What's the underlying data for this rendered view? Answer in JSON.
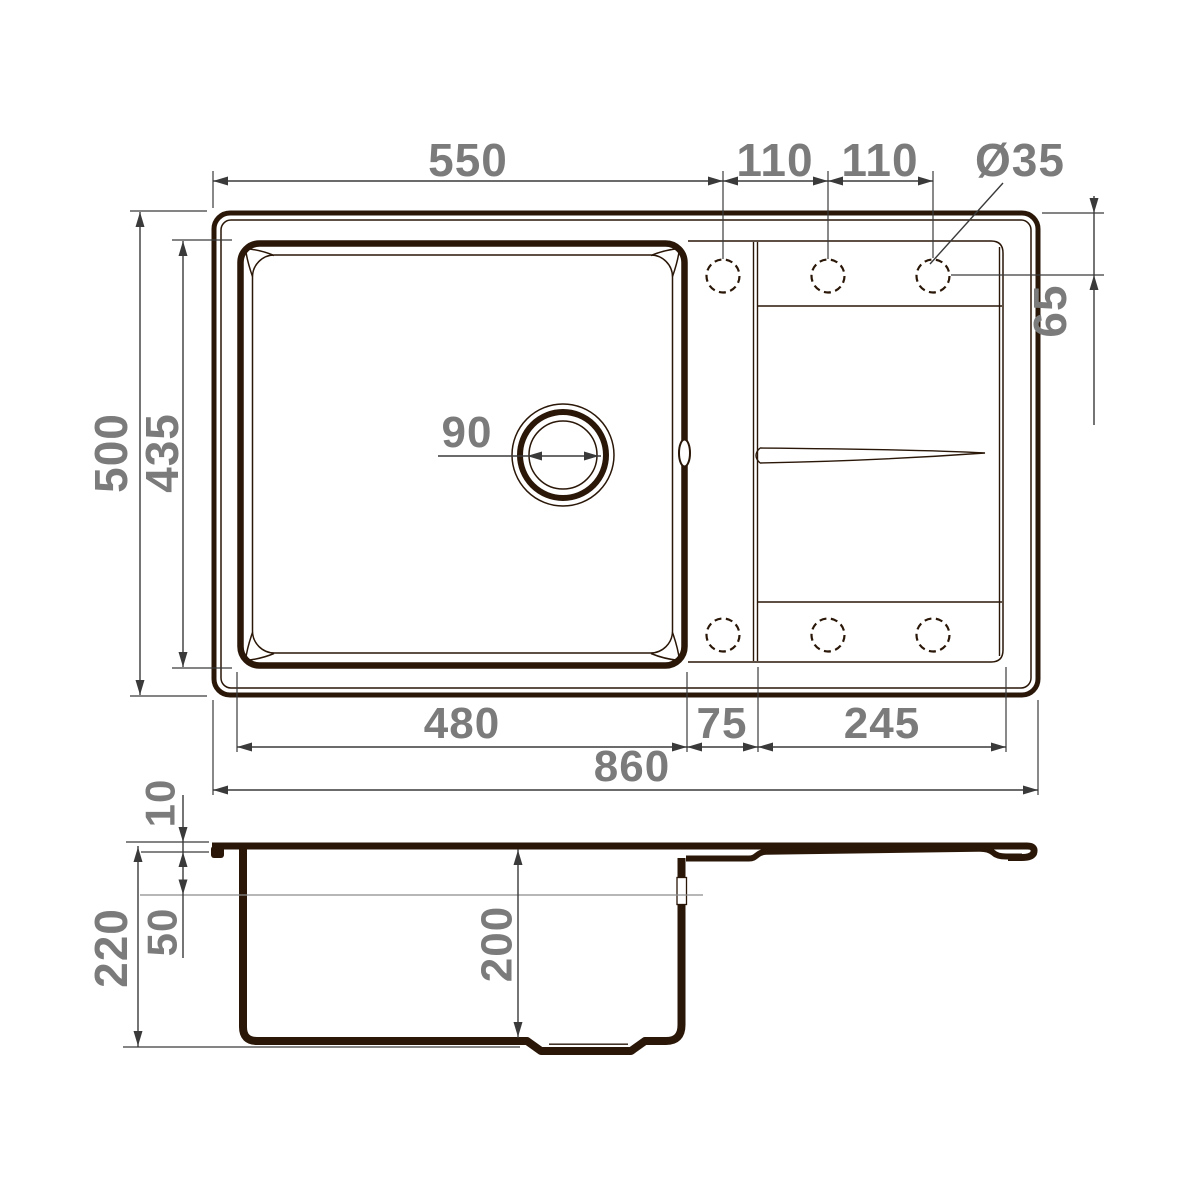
{
  "drawing": {
    "kind": "sink technical drawing, plan view and section view",
    "colors": {
      "background": "#ffffff",
      "outline": "#2a1708",
      "dimension_lines": "#3a3a3a",
      "labels": "#7b7b7b"
    },
    "dimensions": {
      "top_view": {
        "bowl_outer_width_top": "550",
        "hole_spacing_left": "110",
        "hole_spacing_right": "110",
        "hole_diameter": "Ø35",
        "overall_depth": "500",
        "bowl_depth": "435",
        "hole_center_offset": "65",
        "drain_diameter": "90",
        "bowl_width_bottom": "480",
        "bowl_to_board_gap": "75",
        "drainboard_width": "245",
        "overall_width": "860"
      },
      "section_view": {
        "rim_height": "10",
        "overflow_level": "50",
        "overall_height": "220",
        "bowl_inner_depth": "200"
      }
    }
  }
}
